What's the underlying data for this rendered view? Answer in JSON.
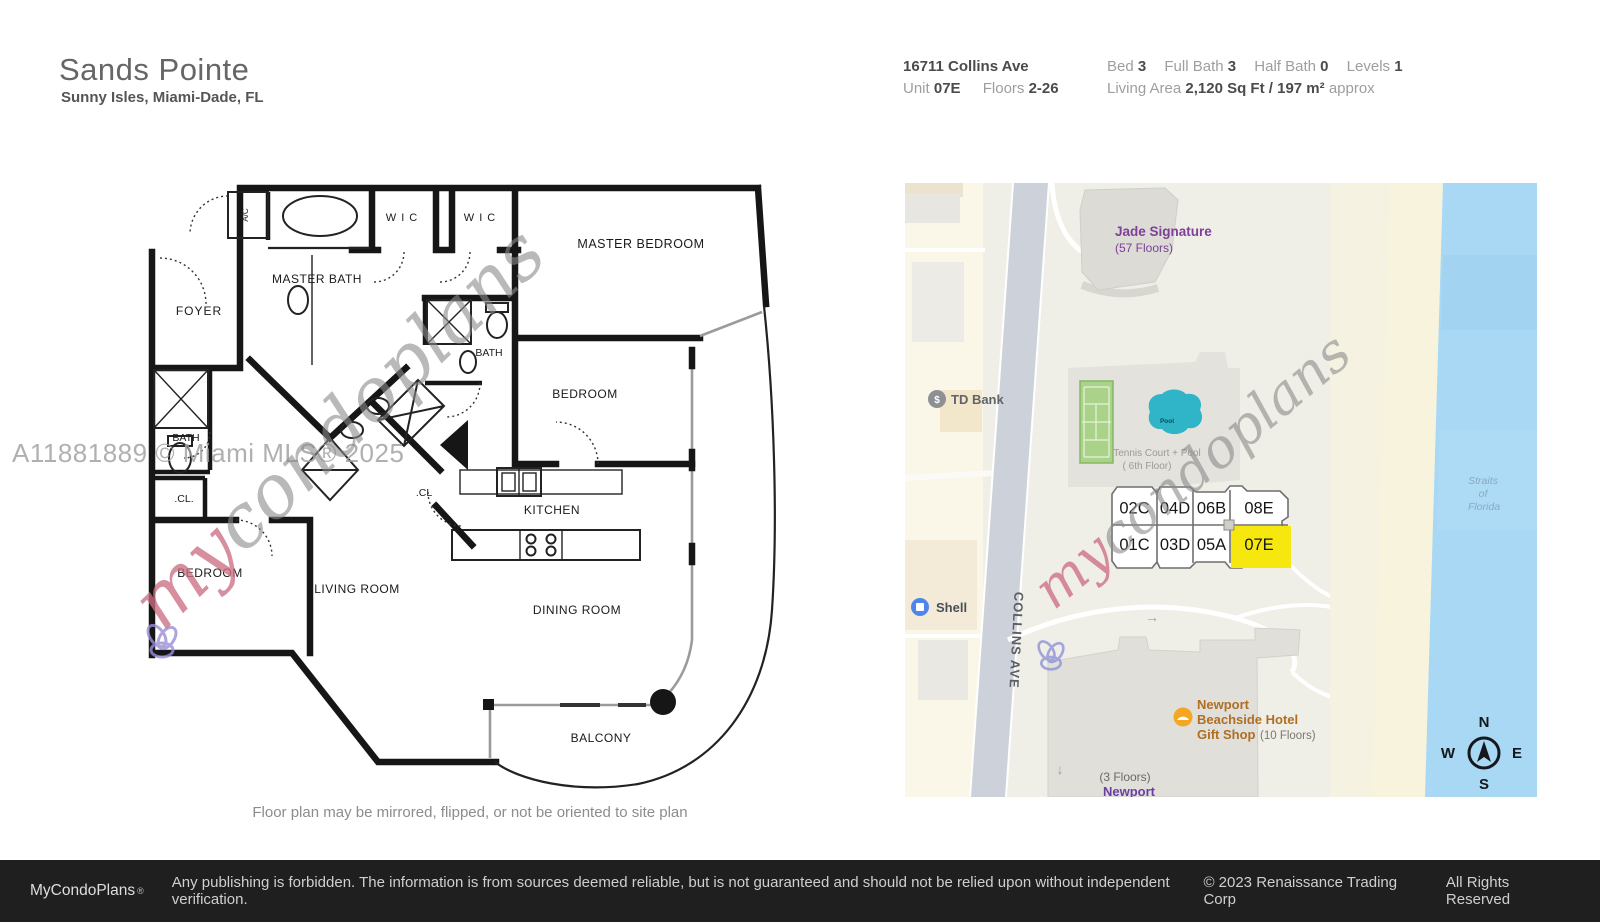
{
  "header": {
    "title": "Sands Pointe",
    "subtitle": "Sunny Isles, Miami-Dade, FL",
    "address": "16711 Collins Ave",
    "unit_label": "Unit",
    "unit_value": "07E",
    "floors_label": "Floors",
    "floors_value": "2-26",
    "bed_label": "Bed",
    "bed_value": "3",
    "full_bath_label": "Full Bath",
    "full_bath_value": "3",
    "half_bath_label": "Half Bath",
    "half_bath_value": "0",
    "levels_label": "Levels",
    "levels_value": "1",
    "living_label": "Living Area",
    "living_value": "2,120 Sq Ft",
    "living_sep": "/",
    "living_metric": "197 m²",
    "living_approx": "approx"
  },
  "floorplan": {
    "caption": "Floor plan may be mirrored, flipped, or not be oriented to site plan",
    "mls_watermark": "A11881889 © Miami MLS® 2025",
    "labels": [
      {
        "t": "MASTER BEDROOM",
        "x": 641,
        "y": 248,
        "s": 12.5,
        "sp": 0.5
      },
      {
        "t": "MASTER BATH",
        "x": 317,
        "y": 283,
        "s": 12,
        "sp": 0.5
      },
      {
        "t": "W I C",
        "x": 402,
        "y": 221,
        "s": 11,
        "sp": 1
      },
      {
        "t": "W I C",
        "x": 480,
        "y": 221,
        "s": 11,
        "sp": 1
      },
      {
        "t": "A/C",
        "x": 248,
        "y": 215,
        "s": 8,
        "r": -90
      },
      {
        "t": "FOYER",
        "x": 199,
        "y": 315,
        "s": 12,
        "sp": 1
      },
      {
        "t": "BATH",
        "x": 186,
        "y": 441,
        "s": 10.5
      },
      {
        "t": ".CL.",
        "x": 184,
        "y": 502,
        "s": 10.5
      },
      {
        "t": "BEDROOM",
        "x": 210,
        "y": 577,
        "s": 12,
        "sp": 0.5
      },
      {
        "t": "BATH",
        "x": 489,
        "y": 356,
        "s": 10.5
      },
      {
        "t": "BEDROOM",
        "x": 585,
        "y": 398,
        "s": 12,
        "sp": 0.5
      },
      {
        "t": ".CL",
        "x": 424,
        "y": 496,
        "s": 10.5
      },
      {
        "t": "KITCHEN",
        "x": 552,
        "y": 514,
        "s": 12,
        "sp": 0.5
      },
      {
        "t": "LIVING ROOM",
        "x": 357,
        "y": 593,
        "s": 12,
        "sp": 0.5
      },
      {
        "t": "DINING ROOM",
        "x": 577,
        "y": 614,
        "s": 12,
        "sp": 0.5
      },
      {
        "t": "BALCONY",
        "x": 601,
        "y": 742,
        "s": 12,
        "sp": 0.5
      }
    ]
  },
  "watermark": {
    "my": "my",
    "rest": "condoplans"
  },
  "map": {
    "units": {
      "rows": [
        [
          "02C",
          "04D",
          "06B",
          "08E"
        ],
        [
          "01C",
          "03D",
          "05A",
          "07E"
        ]
      ],
      "highlighted": "07E"
    },
    "labels": [
      {
        "t": "Jade Signature",
        "x": 1115,
        "y": 236,
        "s": 13.5,
        "c": "#7d3f98",
        "a": "start",
        "w": "600"
      },
      {
        "t": "(57 Floors)",
        "x": 1115,
        "y": 252,
        "s": 12,
        "c": "#7d3f98",
        "a": "start"
      },
      {
        "t": "TD Bank",
        "x": 951,
        "y": 404,
        "s": 13,
        "c": "#606468",
        "a": "start",
        "w": "600"
      },
      {
        "t": "Shell",
        "x": 936,
        "y": 612,
        "s": 13,
        "c": "#4a5058",
        "a": "start",
        "w": "600"
      },
      {
        "t": "COLLINS AVE",
        "x": 1012,
        "y": 640,
        "s": 13,
        "c": "#5b5f64",
        "r": 93,
        "w": "600",
        "sp": 1
      },
      {
        "t": "Tennis Court + Pool",
        "x": 1157,
        "y": 456,
        "s": 10,
        "c": "#9b9b92"
      },
      {
        "t": "( 6th Floor)",
        "x": 1147,
        "y": 469,
        "s": 10,
        "c": "#9b9b92"
      },
      {
        "t": "Pool",
        "x": 1167,
        "y": 423,
        "s": 6.5,
        "c": "#0b4f57",
        "w": "700"
      },
      {
        "t": "Newport",
        "x": 1197,
        "y": 709,
        "s": 13,
        "c": "#b06e21",
        "a": "start",
        "w": "700"
      },
      {
        "t": "Beachside Hotel",
        "x": 1197,
        "y": 724,
        "s": 13,
        "c": "#b06e21",
        "a": "start",
        "w": "700"
      },
      {
        "t": "Gift Shop",
        "x": 1197,
        "y": 739,
        "s": 13,
        "c": "#b06e21",
        "a": "start",
        "w": "700"
      },
      {
        "t": "(10 Floors)",
        "x": 1260,
        "y": 739,
        "s": 11.5,
        "c": "#7c786f",
        "a": "start"
      },
      {
        "t": "(3 Floors)",
        "x": 1125,
        "y": 781,
        "s": 12,
        "c": "#6a6a64"
      },
      {
        "t": "Newport",
        "x": 1129,
        "y": 796,
        "s": 13,
        "c": "#6b3fa0",
        "w": "700"
      },
      {
        "t": "Straits",
        "x": 1483,
        "y": 484,
        "s": 10.5,
        "c": "#8aa9bd",
        "i": 1
      },
      {
        "t": "of",
        "x": 1483,
        "y": 497,
        "s": 10.5,
        "c": "#8aa9bd",
        "i": 1
      },
      {
        "t": "Florida",
        "x": 1484,
        "y": 510,
        "s": 10.5,
        "c": "#8aa9bd",
        "i": 1
      },
      {
        "t": "N",
        "x": 1484,
        "y": 727,
        "s": 15,
        "c": "#14181c",
        "w": "700"
      },
      {
        "t": "W",
        "x": 1448,
        "y": 758,
        "s": 15,
        "c": "#14181c",
        "w": "700"
      },
      {
        "t": "E",
        "x": 1517,
        "y": 758,
        "s": 15,
        "c": "#14181c",
        "w": "700"
      },
      {
        "t": "S",
        "x": 1484,
        "y": 789,
        "s": 15,
        "c": "#14181c",
        "w": "700"
      },
      {
        "t": "→",
        "x": 1152,
        "y": 622,
        "s": 14,
        "c": "#9aa0a6"
      },
      {
        "t": "↓",
        "x": 1060,
        "y": 774,
        "s": 14,
        "c": "#9aa0a6"
      },
      {
        "t": "$",
        "x": 937,
        "y": 403,
        "s": 10,
        "c": "#ffffff",
        "w": "700"
      }
    ],
    "colors": {
      "highlight": "#f6e70e",
      "water": "#a8d8f4",
      "sand": "#f7f3dc",
      "road": "#cdd2da",
      "map_bg": "#efeee7",
      "poi_purple": "#7d3f98",
      "poi_orange": "#b06e21",
      "pool": "#2fb4c8",
      "tennis": "#abd289"
    }
  },
  "footer": {
    "brand": "MyCondoPlans",
    "reg": "®",
    "disclaimer": "Any publishing is forbidden. The information is from sources deemed reliable, but is not guaranteed and should not be relied upon without independent verification.",
    "copyright": "© 2023 Renaissance Trading Corp",
    "rights": "All Rights Reserved"
  }
}
